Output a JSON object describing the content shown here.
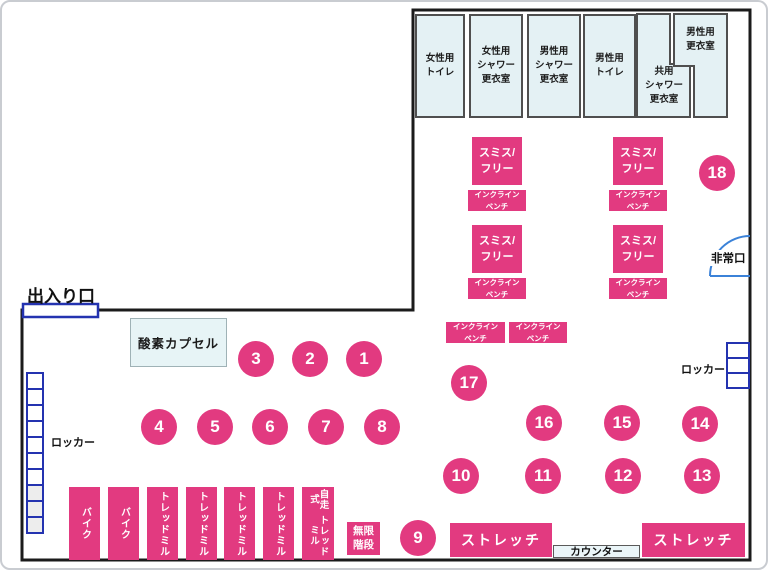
{
  "labels": {
    "entrance": "出入り口",
    "emergency_exit": "非常口",
    "oxygen_capsule": "酸素カプセル",
    "counter": "カウンター",
    "infinite_stairs": "無限\n階段"
  },
  "locker_labels": [
    "ロッカー",
    "ロッカー"
  ],
  "stretch_areas": [
    "ストレッチ",
    "ストレッチ"
  ],
  "rooms": [
    {
      "label": "女性用\nトイレ"
    },
    {
      "label": "女性用\nシャワー\n更衣室"
    },
    {
      "label": "男性用\nシャワー\n更衣室"
    },
    {
      "label": "男性用\nトイレ"
    },
    {
      "label": "共用\nシャワー\n更衣室"
    },
    {
      "label": "男性用\n更衣室"
    }
  ],
  "smith_free": {
    "label": "スミス/\nフリー",
    "count": 4
  },
  "incline_bench": {
    "label": "インクライン\nベンチ",
    "count": 6
  },
  "machines": [
    {
      "label": "バイク"
    },
    {
      "label": "バイク"
    },
    {
      "label": "トレッドミル"
    },
    {
      "label": "トレッドミル"
    },
    {
      "label": "トレッドミル"
    },
    {
      "label": "トレッドミル"
    },
    {
      "line1": "自走式",
      "line2": "トレッドミル"
    }
  ],
  "stations": [
    "1",
    "2",
    "3",
    "4",
    "5",
    "6",
    "7",
    "8",
    "9",
    "10",
    "11",
    "12",
    "13",
    "14",
    "15",
    "16",
    "17",
    "18"
  ],
  "colors": {
    "pink": "#e23a80",
    "room_fill": "#e4f1f4",
    "wall": "#1b1b1b",
    "door_blue": "#2433b0",
    "exit_arc_blue": "#3b82d8"
  }
}
